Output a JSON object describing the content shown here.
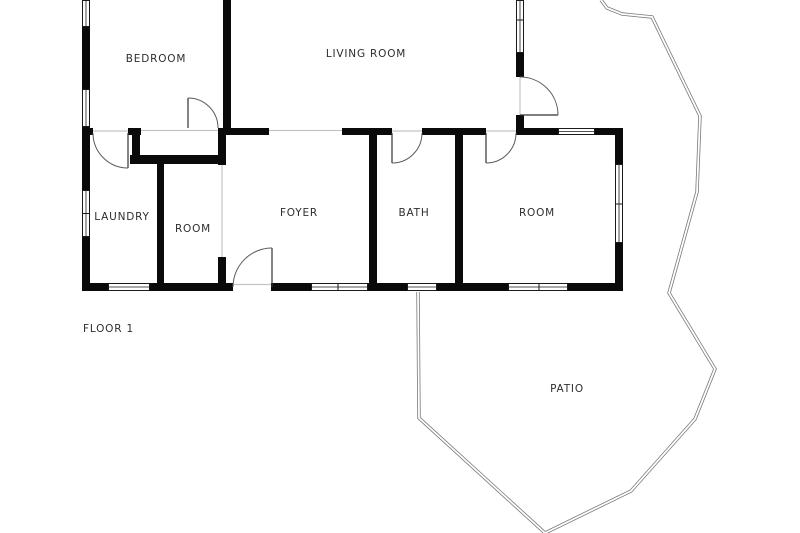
{
  "plan": {
    "floor_label": "FLOOR 1",
    "rooms": [
      {
        "name": "bedroom",
        "label": "BEDROOM"
      },
      {
        "name": "living-room",
        "label": "LIVING ROOM"
      },
      {
        "name": "laundry",
        "label": "LAUNDRY"
      },
      {
        "name": "room-small",
        "label": "ROOM"
      },
      {
        "name": "foyer",
        "label": "FOYER"
      },
      {
        "name": "bath",
        "label": "BATH"
      },
      {
        "name": "room-right",
        "label": "ROOM"
      },
      {
        "name": "patio",
        "label": "PATIO"
      }
    ],
    "colors": {
      "wall": "#0a0a0a",
      "background": "#ffffff",
      "patio_outline": "#7a7a7a",
      "door_arc": "#5a5a5a",
      "threshold": "#c4c4c4",
      "text": "#2e2e2e"
    }
  }
}
